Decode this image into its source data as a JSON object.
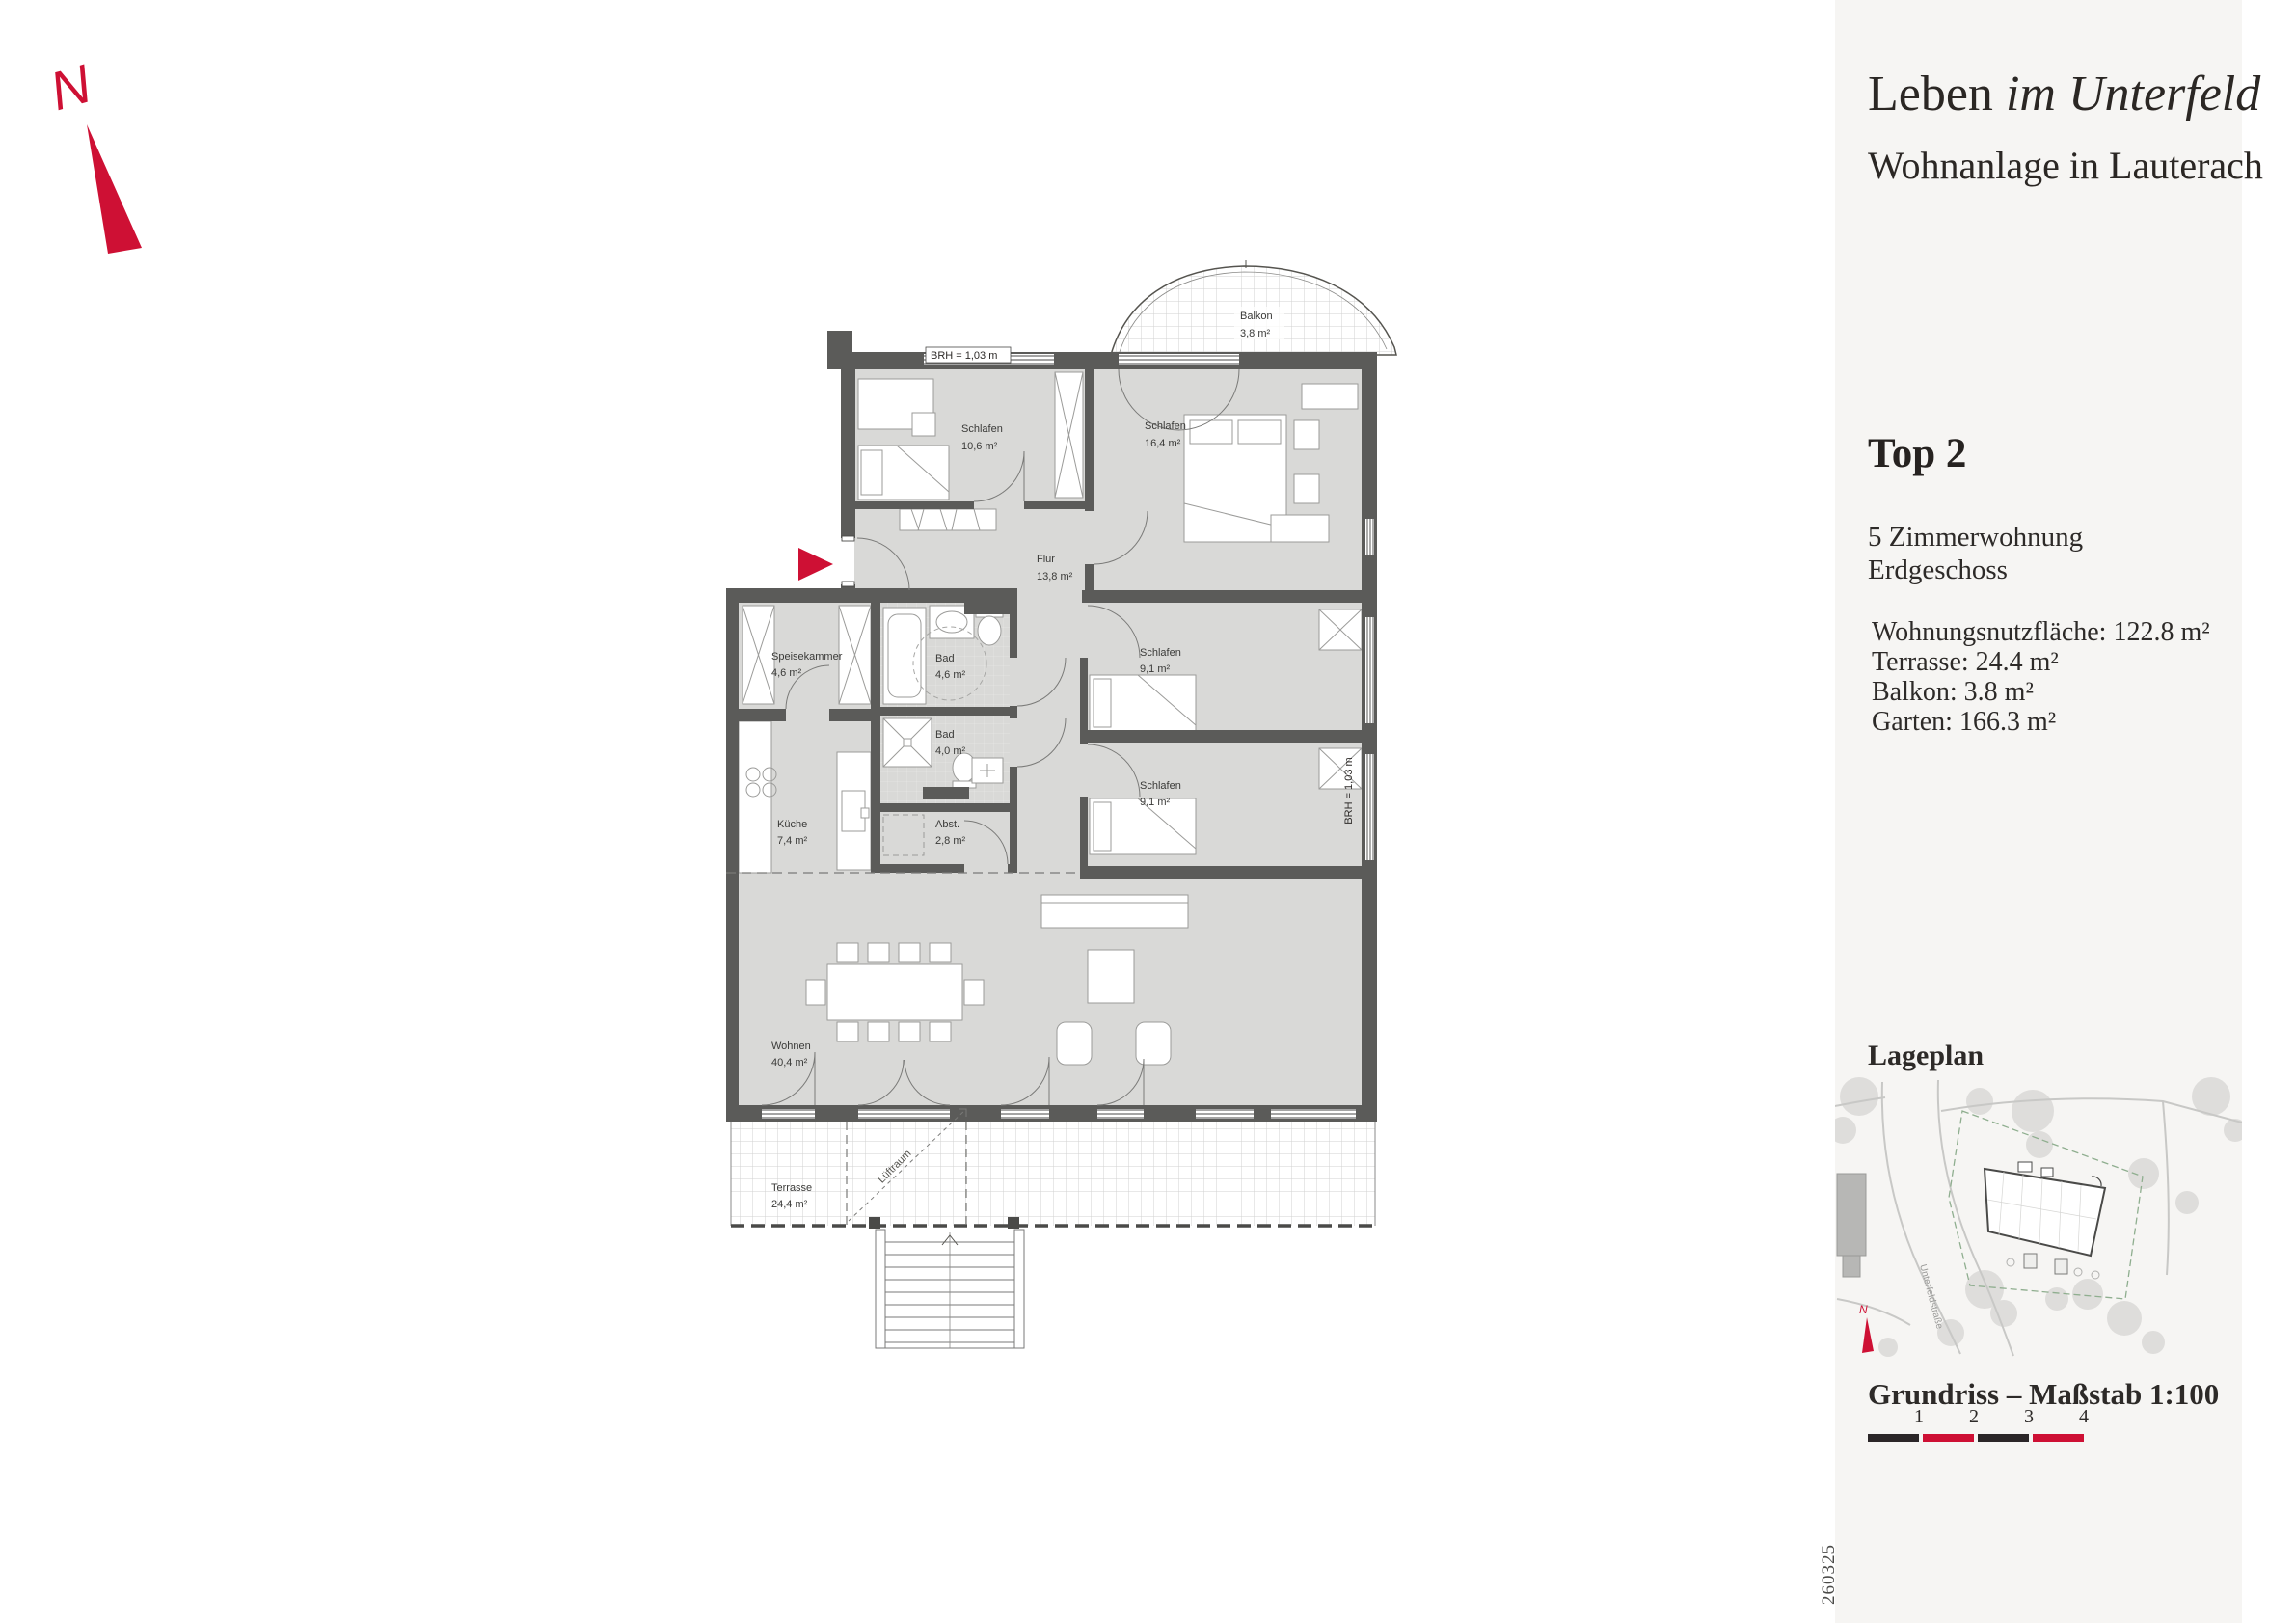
{
  "north": {
    "label": "N"
  },
  "sidebar": {
    "title_regular": "Leben",
    "title_italic": "im Unterfeld",
    "subtitle": "Wohnanlage in Lauterach",
    "unit_title": "Top 2",
    "unit_line1": "5 Zimmerwohnung",
    "unit_line2": "Erdgeschoss",
    "areas": {
      "a0": "Wohnungsnutzfläche: 122.8 m²",
      "a1": "Terrasse: 24.4 m²",
      "a2": "Balkon: 3.8 m²",
      "a3": "Garten: 166.3 m²"
    },
    "lageplan_heading": "Lageplan",
    "street_label": "Unterfeldstraße",
    "siteplan_north_label": "N",
    "scale_heading": "Grundriss – Maßstab 1:100",
    "scale_ticks": {
      "t1": "1",
      "t2": "2",
      "t3": "3",
      "t4": "4"
    },
    "doc_number": "260325"
  },
  "plan": {
    "brh_top": "BRH = 1,03 m",
    "brh_right": "BRH = 1,03 m",
    "void_label": "Lüftraum",
    "rooms": {
      "balkon": {
        "name": "Balkon",
        "area": "3,8 m²"
      },
      "schlafen1": {
        "name": "Schlafen",
        "area": "10,6 m²"
      },
      "schlafen2": {
        "name": "Schlafen",
        "area": "16,4 m²"
      },
      "flur": {
        "name": "Flur",
        "area": "13,8 m²"
      },
      "speisekammer": {
        "name": "Speisekammer",
        "area": "4,6 m²"
      },
      "bad1": {
        "name": "Bad",
        "area": "4,6 m²"
      },
      "schlafen3": {
        "name": "Schlafen",
        "area": "9,1 m²"
      },
      "bad2": {
        "name": "Bad",
        "area": "4,0 m²"
      },
      "schlafen4": {
        "name": "Schlafen",
        "area": "9,1 m²"
      },
      "kueche": {
        "name": "Küche",
        "area": "7,4 m²"
      },
      "abst": {
        "name": "Abst.",
        "area": "2,8 m²"
      },
      "wohnen": {
        "name": "Wohnen",
        "area": "40,4 m²"
      },
      "terrasse": {
        "name": "Terrasse",
        "area": "24,4 m²"
      }
    }
  },
  "colors": {
    "accent_red": "#ce1034",
    "scale_dark": "#2b2628",
    "wall_gray": "#5b5b59",
    "room_fill": "#d9d9d7",
    "sidebar_bg": "#f6f5f3"
  }
}
